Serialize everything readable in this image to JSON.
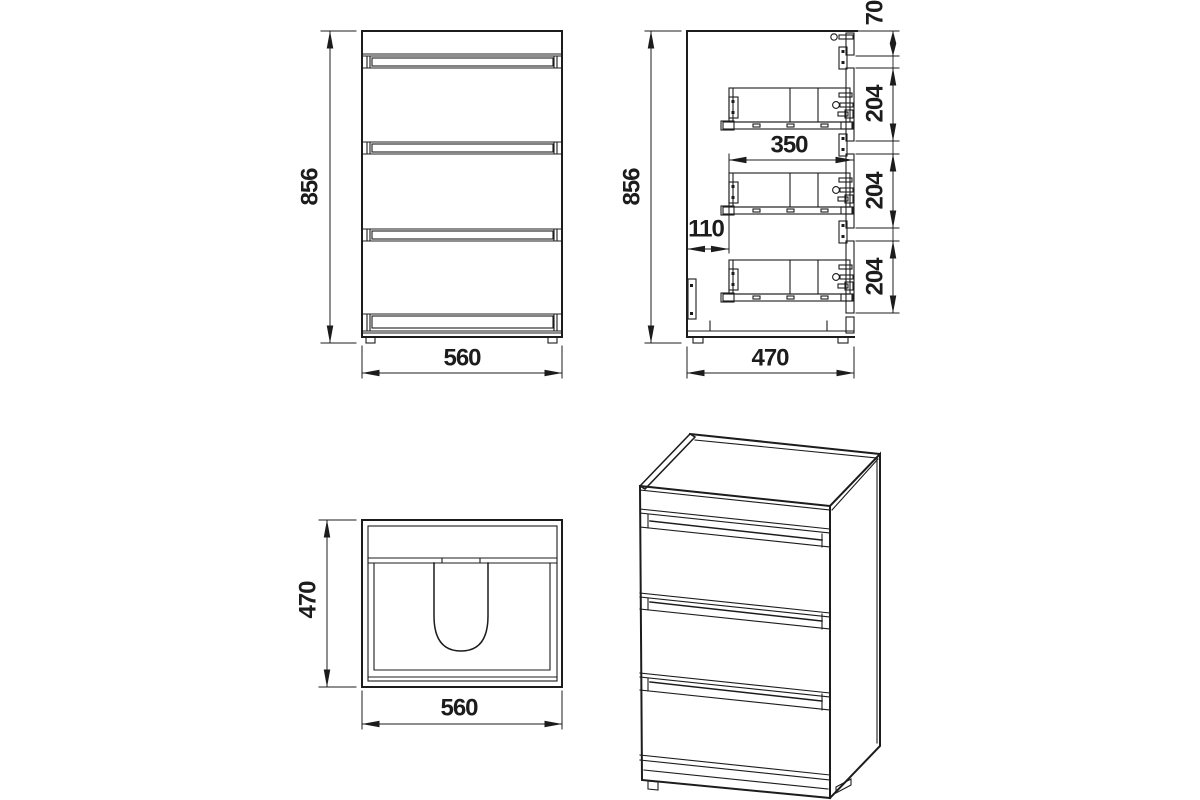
{
  "drawing": {
    "front_view": {
      "height": "856",
      "width": "560"
    },
    "side_view": {
      "height": "856",
      "depth": "470",
      "top_panel_height": "70",
      "drawer_pitch": [
        "204",
        "204",
        "204"
      ],
      "slide_length": "350",
      "back_clearance": "110"
    },
    "top_view": {
      "depth": "470",
      "width": "560"
    },
    "colors": {
      "line": "#1c1c1c",
      "background": "#ffffff"
    }
  }
}
